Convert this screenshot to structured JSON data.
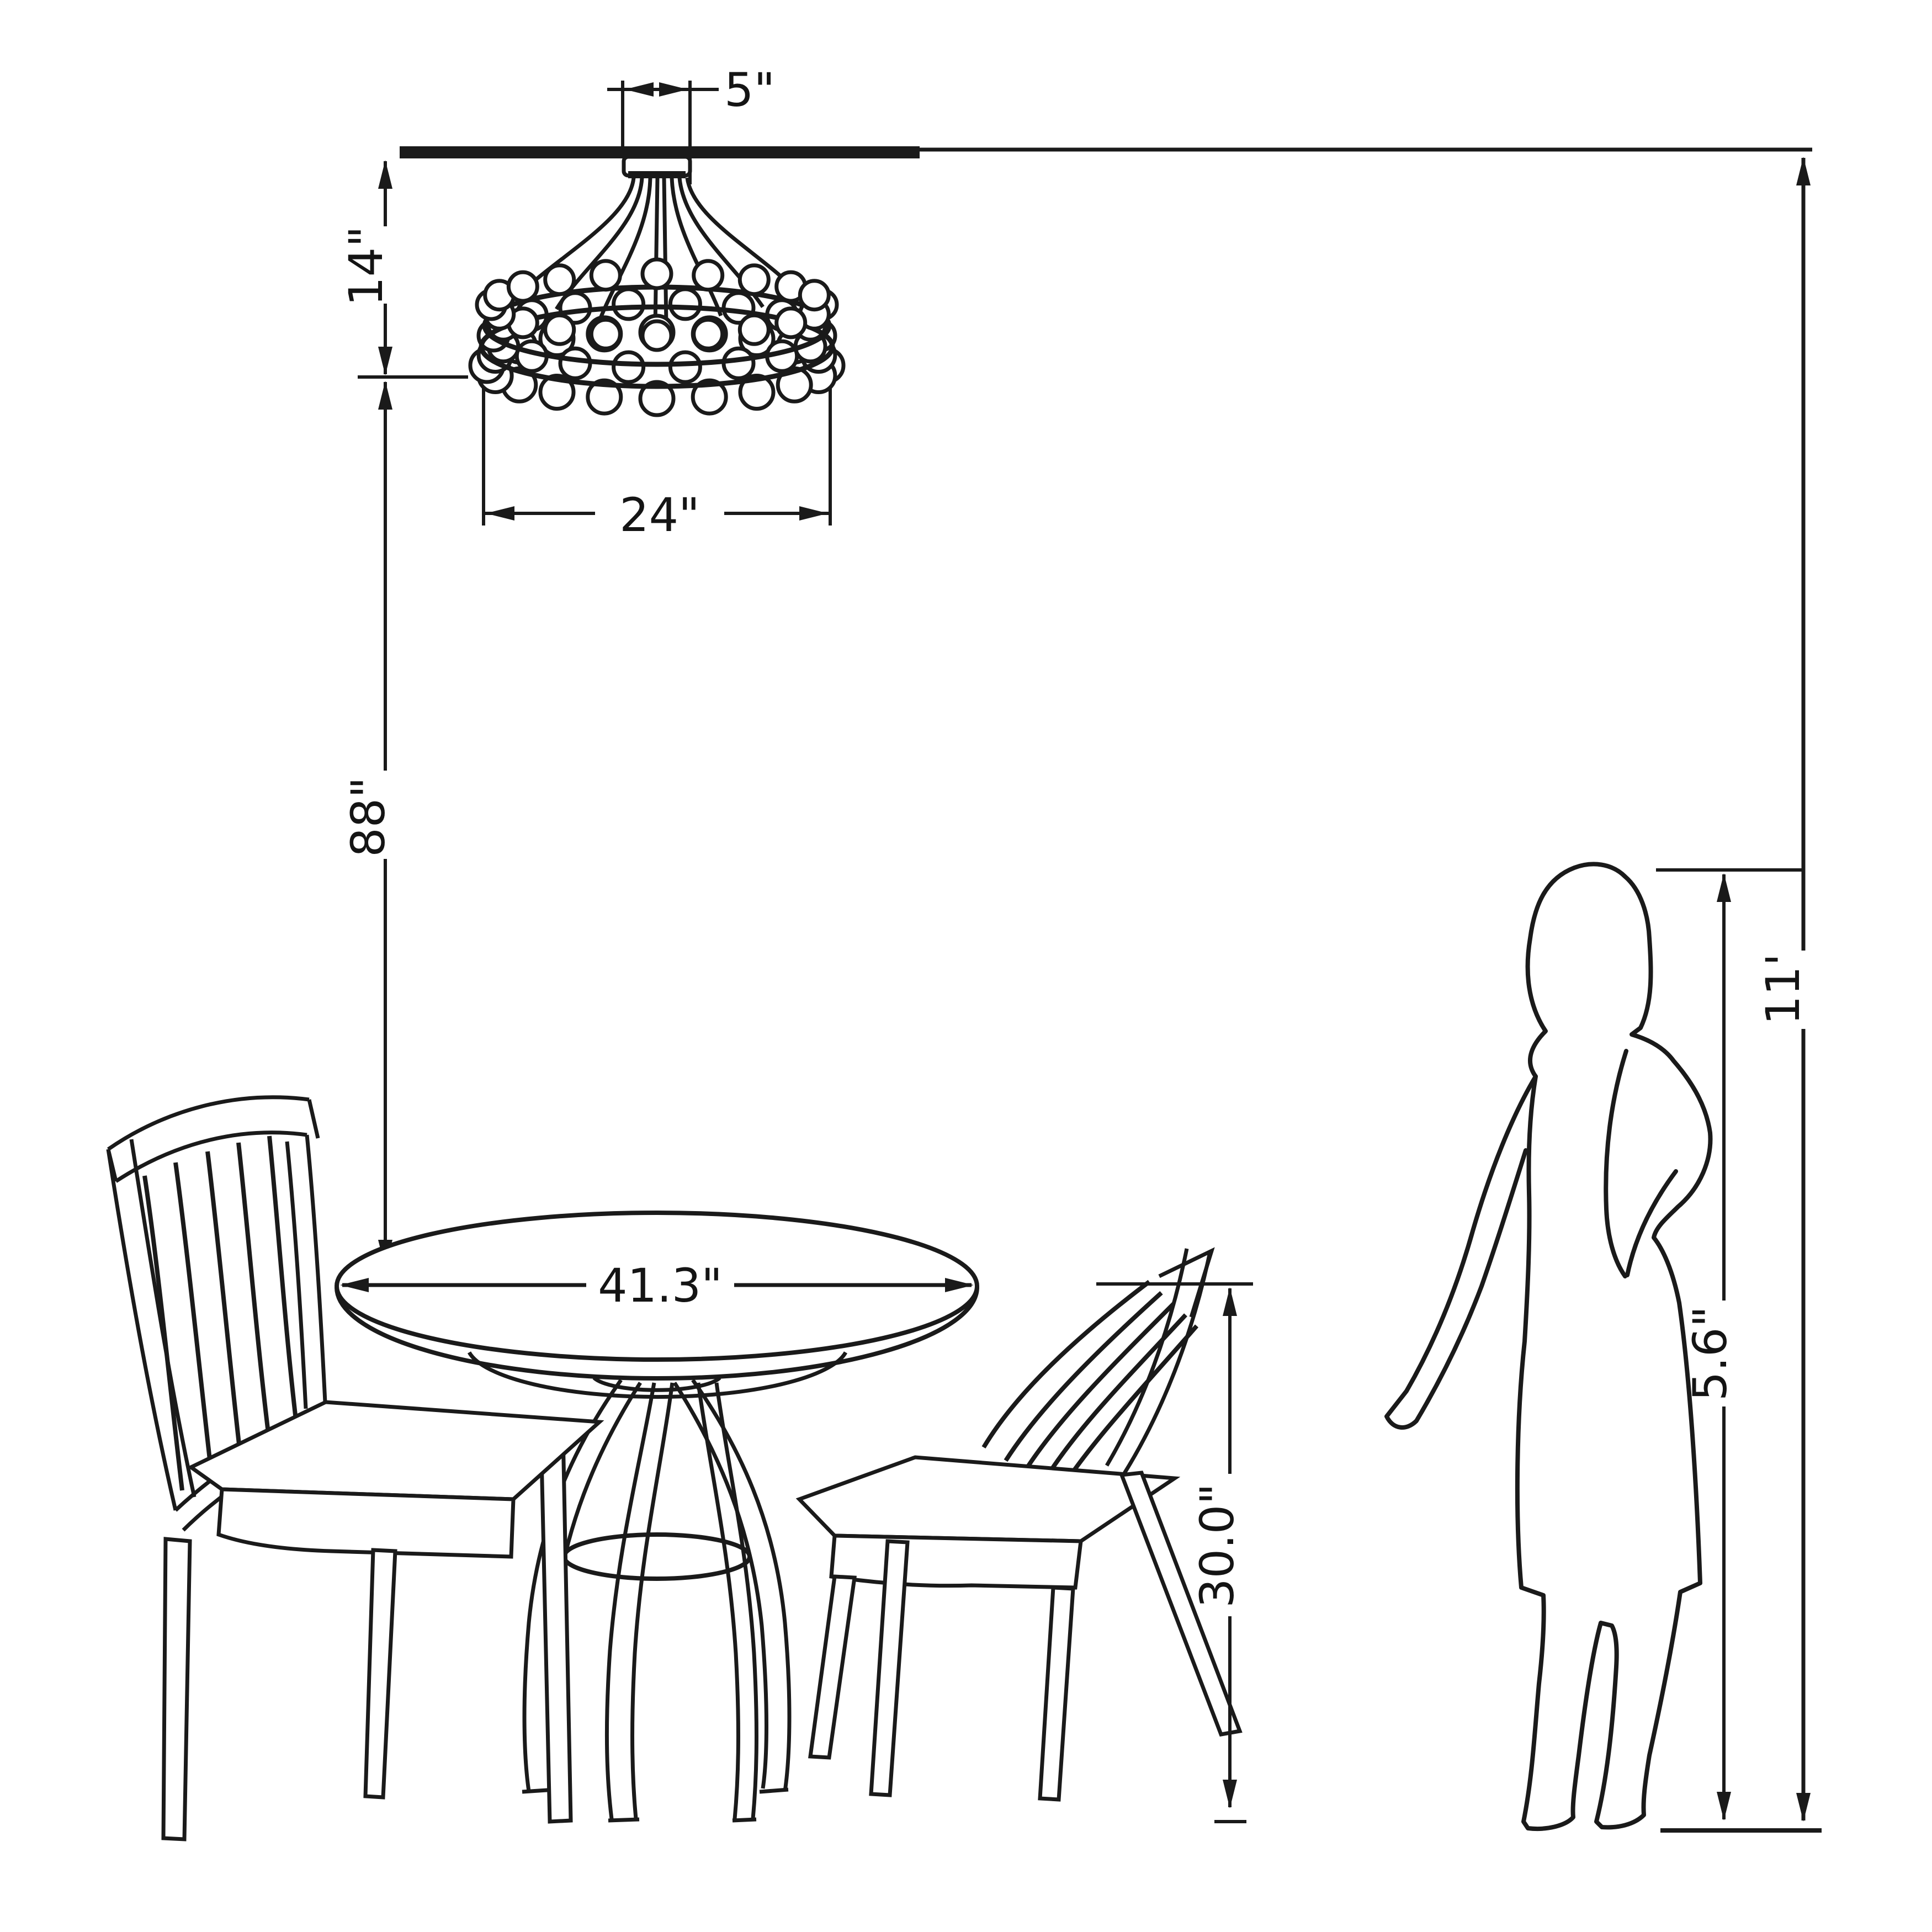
{
  "title": "Dining set with chandelier — dimensional diagram",
  "colors": {
    "line": "#1a1a1a",
    "background": "#ffffff"
  },
  "objects": {
    "ceiling": "ceiling line",
    "chandelier": "beaded drum chandelier",
    "table": "round pedestal dining table",
    "chair_left": "slat-back dining chair (left)",
    "chair_right": "slat-back dining chair (right)",
    "person": "standing woman silhouette (scale reference)"
  },
  "dimensions": {
    "canopy_width": {
      "label": "5\"",
      "meaning": "chandelier canopy width"
    },
    "chandelier_height": {
      "label": "14\"",
      "meaning": "ceiling to bottom of chandelier"
    },
    "chandelier_diameter": {
      "label": "24\"",
      "meaning": "chandelier diameter"
    },
    "drop_to_table": {
      "label": "88\"",
      "meaning": "chandelier bottom to table top"
    },
    "table_diameter": {
      "label": "41.3\"",
      "meaning": "table top diameter"
    },
    "table_height": {
      "label": "30.0\"",
      "meaning": "floor to table top"
    },
    "person_height": {
      "label": "5.6\"",
      "meaning": "height of person"
    },
    "ceiling_height": {
      "label": "11'",
      "meaning": "floor to ceiling"
    }
  }
}
